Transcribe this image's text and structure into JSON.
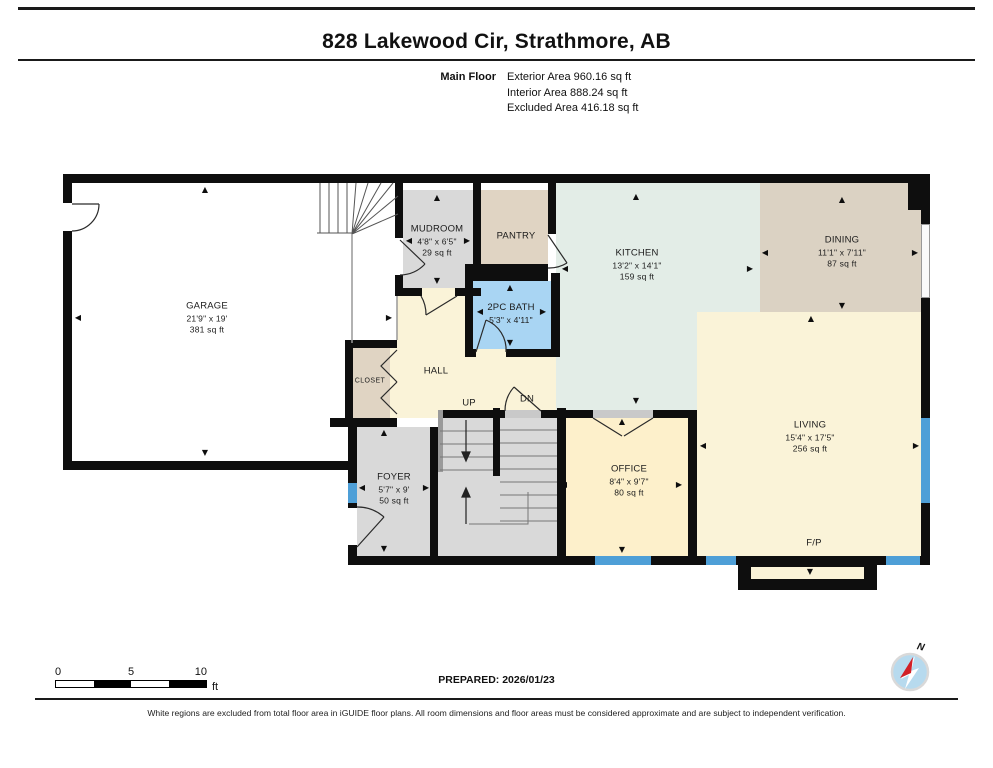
{
  "header": {
    "title": "828 Lakewood Cir, Strathmore, AB",
    "floor_label": "Main Floor",
    "area_lines": [
      "Exterior Area 960.16 sq ft",
      "Interior Area 888.24 sq ft",
      "Excluded Area 416.18 sq ft"
    ]
  },
  "rooms": {
    "garage": {
      "name": "GARAGE",
      "dims": "21'9\" x 19'",
      "area": "381 sq ft"
    },
    "mudroom": {
      "name": "MUDROOM",
      "dims": "4'8\" x 6'5\"",
      "area": "29 sq ft"
    },
    "pantry": {
      "name": "PANTRY"
    },
    "kitchen": {
      "name": "KITCHEN",
      "dims": "13'2\" x 14'1\"",
      "area": "159 sq ft"
    },
    "dining": {
      "name": "DINING",
      "dims": "11'1\" x 7'11\"",
      "area": "87 sq ft"
    },
    "living": {
      "name": "LIVING",
      "dims": "15'4\" x 17'5\"",
      "area": "256 sq ft"
    },
    "bath": {
      "name": "2PC BATH",
      "dims": "5'3\" x 4'11\""
    },
    "hall": {
      "name": "HALL"
    },
    "closet": {
      "name": "CLOSET"
    },
    "foyer": {
      "name": "FOYER",
      "dims": "5'7\" x 9'",
      "area": "50 sq ft"
    },
    "office": {
      "name": "OFFICE",
      "dims": "8'4\" x 9'7\"",
      "area": "80 sq ft"
    },
    "fireplace": {
      "name": "F/P"
    },
    "stairs": {
      "up_label": "UP",
      "dn_label": "DN"
    }
  },
  "footer": {
    "scale": {
      "t0": "0",
      "t5": "5",
      "t10": "10",
      "unit": "ft"
    },
    "prepared": "PREPARED: 2026/01/23",
    "compass_n": "N",
    "disclaimer": "White regions are excluded from total floor area in iGUIDE floor plans. All room dimensions and floor areas must be considered approximate and are subject to independent verification."
  },
  "icons": {
    "arrow_up": "▲",
    "arrow_down": "▼",
    "arrow_left": "◀",
    "arrow_right": "▶"
  },
  "colors": {
    "wall": "#0e0e0e",
    "window": "#4e9fd7",
    "bath": "#a9d5f3",
    "kitchen": "#e3ede7",
    "living_hall": "#faf3d8",
    "office": "#fdf0cb",
    "tan": "#e0d4c3",
    "dining": "#dbd2c3",
    "gray_room": "#d9d9d9",
    "compass_fill": "#b7daee",
    "compass_needle": "#d22027"
  }
}
